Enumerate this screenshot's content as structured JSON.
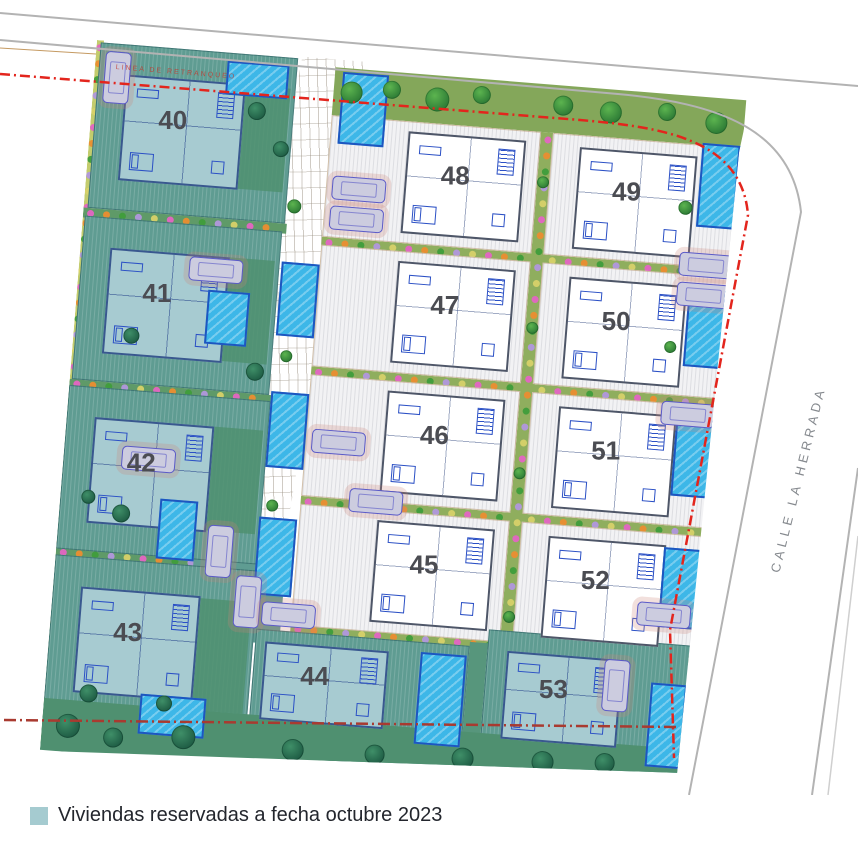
{
  "street": {
    "name": "CALLE LA HERRADA"
  },
  "boundary": {
    "setback_label": "LINEA DE RETRANQUEO"
  },
  "legend": {
    "label": "Viviendas reservadas a fecha octubre 2023",
    "swatch_color": "#a5cbd0"
  },
  "plots": [
    {
      "number": "40",
      "reserved": true,
      "zone": "left",
      "slot": 0
    },
    {
      "number": "41",
      "reserved": true,
      "zone": "left",
      "slot": 1
    },
    {
      "number": "42",
      "reserved": true,
      "zone": "left",
      "slot": 2
    },
    {
      "number": "43",
      "reserved": true,
      "zone": "left",
      "slot": 3
    },
    {
      "number": "44",
      "reserved": true,
      "zone": "bottom",
      "slot": 0
    },
    {
      "number": "45",
      "reserved": false,
      "zone": "center",
      "row": 3,
      "col": 0
    },
    {
      "number": "46",
      "reserved": false,
      "zone": "center",
      "row": 2,
      "col": 0
    },
    {
      "number": "47",
      "reserved": false,
      "zone": "center",
      "row": 1,
      "col": 0
    },
    {
      "number": "48",
      "reserved": false,
      "zone": "center",
      "row": 0,
      "col": 0
    },
    {
      "number": "49",
      "reserved": false,
      "zone": "center",
      "row": 0,
      "col": 1
    },
    {
      "number": "50",
      "reserved": false,
      "zone": "center",
      "row": 1,
      "col": 1
    },
    {
      "number": "51",
      "reserved": false,
      "zone": "center",
      "row": 2,
      "col": 1
    },
    {
      "number": "52",
      "reserved": false,
      "zone": "center",
      "row": 3,
      "col": 1
    },
    {
      "number": "53",
      "reserved": true,
      "zone": "bottom",
      "slot": 1
    }
  ],
  "palette": {
    "reserved_plot": "#5f9c92",
    "reserved_house": "#a7cbd1",
    "open_plot": "#f2f2f4",
    "lawn_green": "#4f9070",
    "strip_olive": "#84a75a",
    "walkway_green": "#8fae5e",
    "edge_band": "#c3cc6d",
    "pool_blue": "#3db7e8",
    "pool_border": "#1e56c0",
    "setback_red": "#e3251d",
    "bottom_boundary_red": "#a93a30",
    "street_line_gray": "#b3b3b3",
    "plot_number_color": "#4b4c52",
    "tree_green": "#2e7c36",
    "flower_pink": "#e465c3",
    "flower_orange": "#eb8d30",
    "flower_purple": "#b197dd",
    "car_fill": "#ccccdf",
    "car_outline": "#5a5ac8"
  }
}
